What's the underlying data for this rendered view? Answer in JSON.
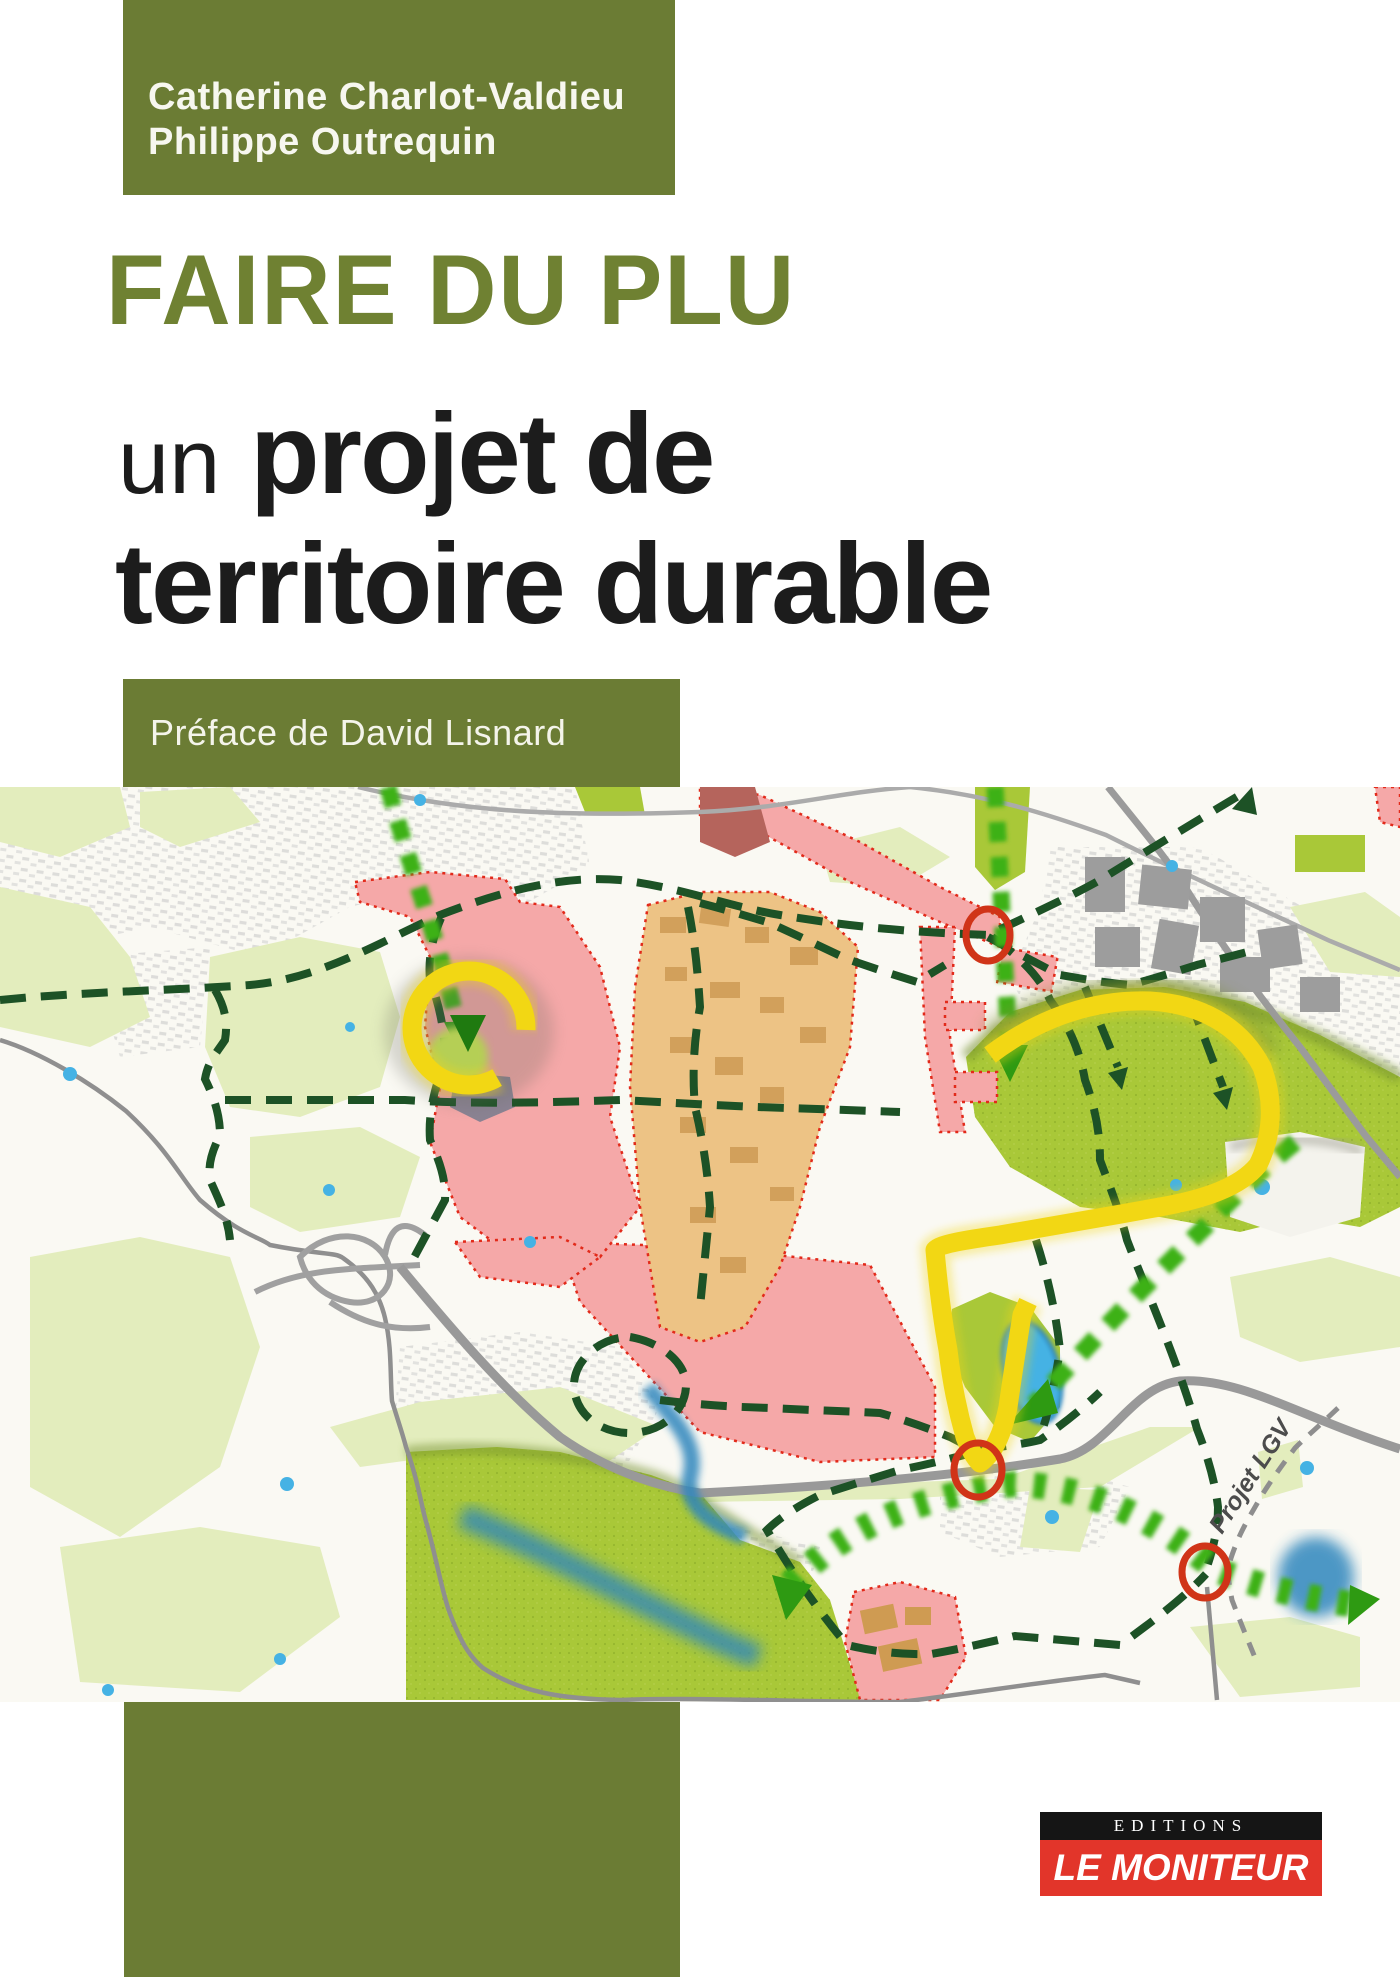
{
  "cover": {
    "authors": {
      "line1": "Catherine Charlot-Valdieu",
      "line2": "Philippe Outrequin"
    },
    "title": {
      "line1": "FAIRE DU PLU",
      "line2_prefix": "un",
      "line2_rest": " projet de",
      "line3": "territoire durable"
    },
    "preface": "Préface de David Lisnard",
    "map": {
      "label_lgv": "Projet LGV"
    },
    "publisher": {
      "imprint": "EDITIONS",
      "name": "LE MONITEUR"
    },
    "colors": {
      "olive_block": "#6b7c34",
      "title_green": "#6f8132",
      "text_black": "#1c1c1c",
      "publisher_red": "#e2352a",
      "publisher_black": "#151515",
      "map_pink_zone": "#f5a8a8",
      "map_pink_border_red": "#e22a1a",
      "map_orange_zone": "#edc385",
      "map_bright_green": "#a9c838",
      "map_pale_green": "#e3edbd",
      "map_dark_green_dash": "#1d5226",
      "map_arrow_green": "#3db117",
      "map_yellow_route": "#f2d714",
      "map_red_circle": "#d03418",
      "map_water_blue": "#45b2e4"
    }
  }
}
